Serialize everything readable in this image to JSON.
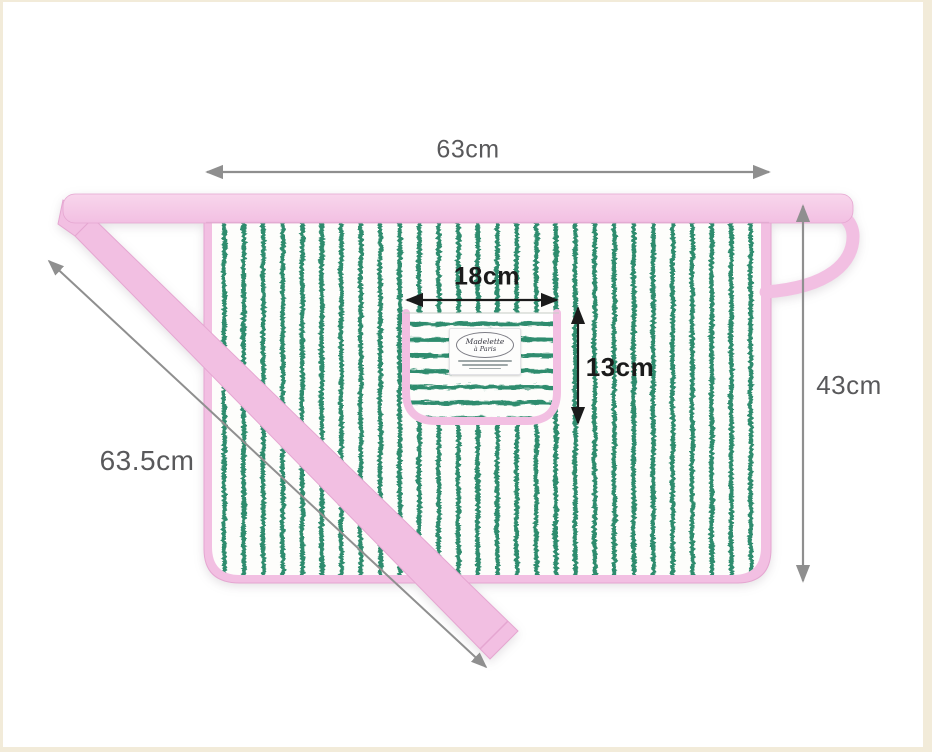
{
  "apron": {
    "dimensions": {
      "width": "63cm",
      "height": "43cm",
      "tie_length": "63.5cm",
      "pocket_width": "18cm",
      "pocket_height": "13cm"
    },
    "pocket_label": {
      "line1": "Madelette",
      "line2": "à Paris"
    },
    "colors": {
      "binding_pink": "#f2bfe2",
      "binding_pink_dark": "#e5a6d1",
      "waistband_light": "#f8d6ec",
      "stripe_green": "#2f8c6e",
      "annotation_gray": "#59595b",
      "annotation_line_gray": "#8f8f8f",
      "annotation_black": "#1b1b1b",
      "frame_beige": "#f2ebd9",
      "fabric_white": "#fdfdfb"
    }
  }
}
